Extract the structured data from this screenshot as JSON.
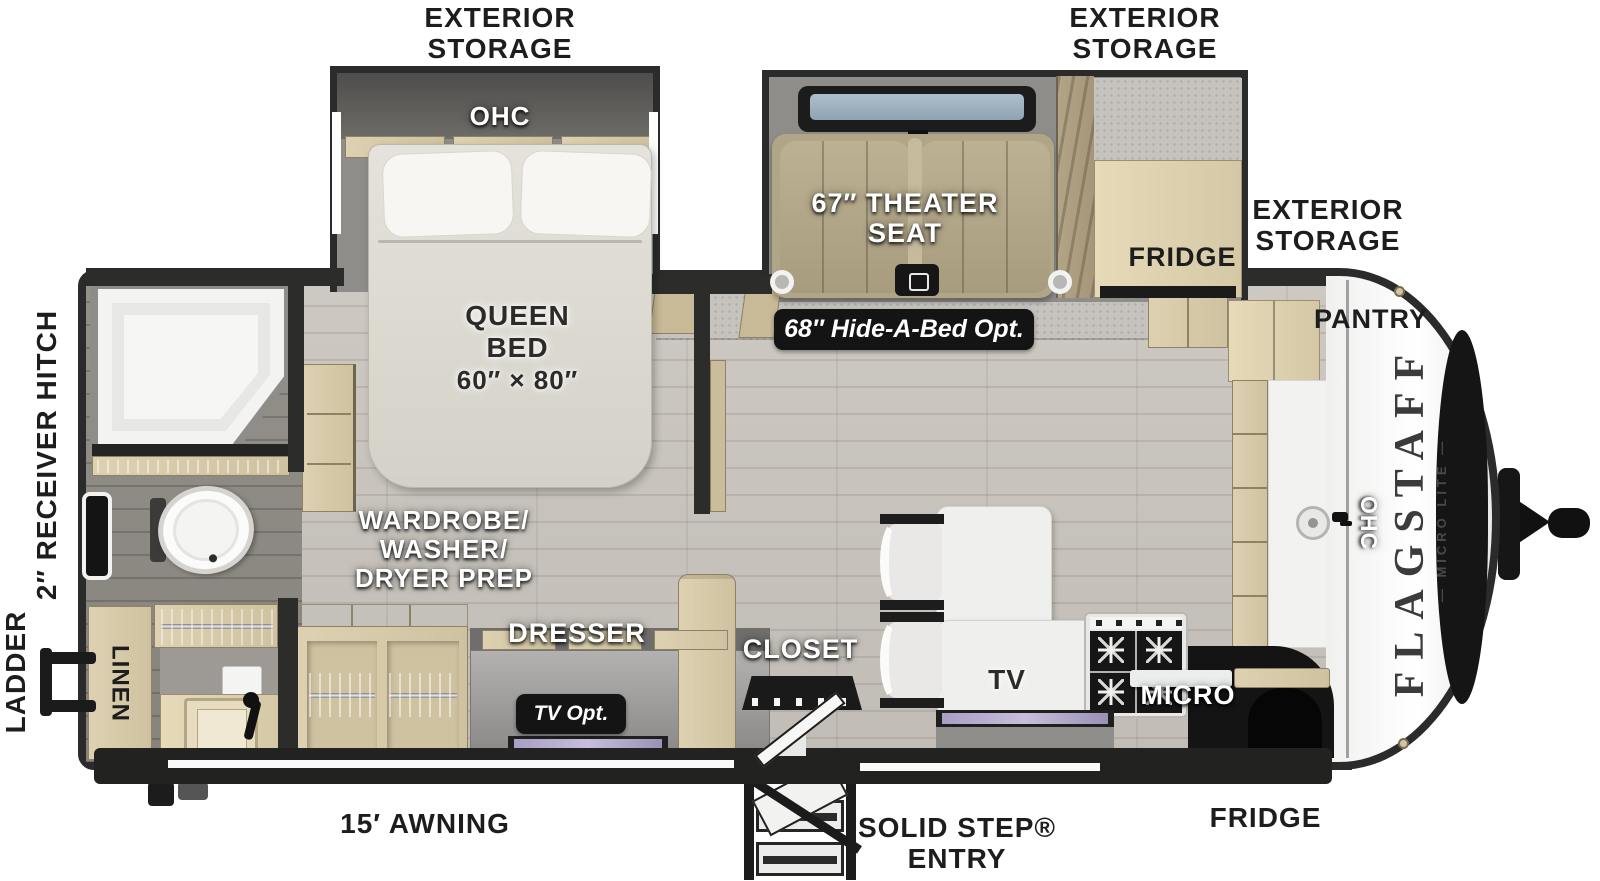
{
  "exterior": {
    "storage_line1": "EXTERIOR",
    "storage_line2": "STORAGE",
    "receiver_hitch": "2″ RECEIVER HITCH",
    "ladder": "LADDER",
    "awning": "15′ AWNING",
    "entry_line1": "SOLID STEP®",
    "entry_line2": "ENTRY",
    "fridge": "FRIDGE"
  },
  "bedroom": {
    "ohc": "OHC",
    "bed_line1": "QUEEN",
    "bed_line2": "BED",
    "bed_line3": "60″ × 80″"
  },
  "living": {
    "theater_line1": "67″ THEATER",
    "theater_line2": "SEAT",
    "hide_a_bed": "68″ Hide-A-Bed Opt.",
    "tv": "TV"
  },
  "kitchen": {
    "fridge_top": "FRIDGE",
    "pantry": "PANTRY",
    "ohc": "OHC",
    "micro": "MICRO"
  },
  "storage": {
    "wardrobe_line1": "WARDROBE/",
    "wardrobe_line2": "WASHER/",
    "wardrobe_line3": "DRYER PREP",
    "dresser": "DRESSER",
    "tv_opt": "TV Opt.",
    "closet": "CLOSET",
    "linen": "LINEN"
  },
  "brand": {
    "name": "FLAGSTAFF",
    "sub": "— MICRO LITE —"
  },
  "colors": {
    "wall": "#2c2c2a",
    "floor": "#c9c5be",
    "bath_floor": "#8f8c86",
    "cabinet_wood": "#d6c9a7",
    "theater_seat": "#b1a588",
    "badge": "#141414",
    "accent_white": "#ffffff"
  }
}
